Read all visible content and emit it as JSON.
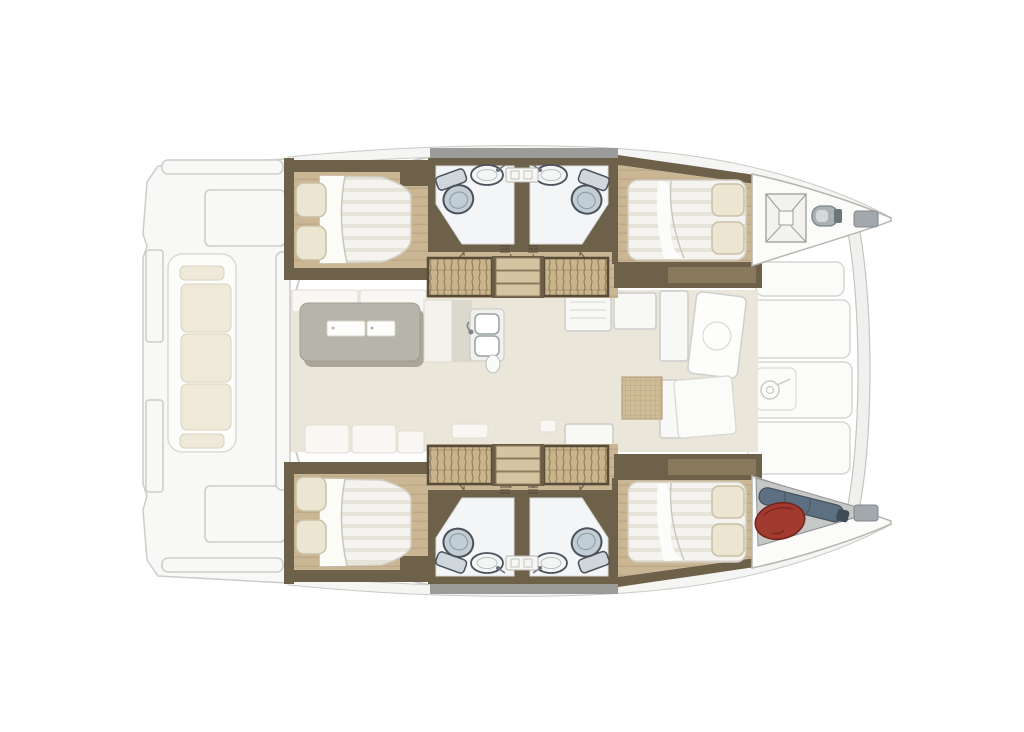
{
  "document": {
    "kind": "catamaran-interior-floor-plan",
    "orientation": "bow-right-stern-left",
    "visible_text": []
  },
  "colors": {
    "canvas": "#ffffff",
    "wall": "#6e6149",
    "wall-mid": "#8a7a5d",
    "wood": "#cbb694",
    "wood-line": "#ae997a",
    "mat": "#c9b48c",
    "mat-line": "#8b7655",
    "steps": "#d5c4a2",
    "saloon-floor": "#eae6da",
    "bath-floor": "#f3f5f6",
    "bed": "#f4f3ef",
    "bed-stripe": "#e6e3d9",
    "pillow": "#ebe5d1",
    "pillow-edge": "#c9c1a6",
    "cushion": "#eee9d8",
    "cushion-edge": "#d9d2bc",
    "table": "#b7b4aa",
    "ghost": "#f8f8f6",
    "ghost-line": "#cccccb",
    "deck": "#fbfbfa",
    "toilet": "#c2cdd5",
    "fixture-line": "#4a525b",
    "hardware": "#aab1b5",
    "red-bag": "#a23a30",
    "fender": "#5d7082",
    "windscreen": "#9b9b99"
  },
  "plan": {
    "port-and-starboard-hulls": {
      "aft-cabins": [
        "double-bed",
        "two-pillows",
        "wood-floor"
      ],
      "mid-bathrooms": [
        "toilet",
        "wash-basin",
        "vanity-shelf",
        "swing-door"
      ],
      "companionways": [
        "three-steps",
        "woven-tread-panels"
      ],
      "forward-cabins": [
        "double-bed",
        "two-pillows",
        "wood-floor"
      ]
    },
    "bridgedeck-saloon": [
      "dining-table",
      "bench-seats",
      "double-galley-sink",
      "galley-counters",
      "woven-floor-mat",
      "open-foredeck-door"
    ],
    "aft-cockpit": [
      "lounge-bench",
      "seat-cushions",
      "transom-steps"
    ],
    "foredeck": [
      "deck-lockers",
      "anchor-hatch",
      "windlass",
      "winch",
      "forward-crossbeam",
      "sail-bag",
      "red-gear-bag",
      "bow-cleats"
    ]
  }
}
